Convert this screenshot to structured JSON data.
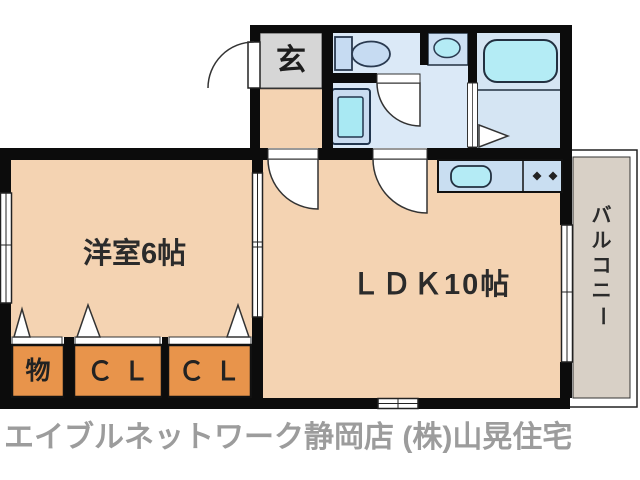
{
  "floor_plan": {
    "rooms": {
      "genkan": "玄",
      "western_room": "洋室6帖",
      "ldk": "ＬＤＫ10帖",
      "storage": "物",
      "closet_1": "ＣＬ",
      "closet_2": "ＣＬ",
      "balcony": "バルコニー",
      "balcony_chars": [
        "バ",
        "ル",
        "コ",
        "ニ",
        "ー"
      ]
    },
    "colors": {
      "wall": "#0c0c0c",
      "room_floor": "#f4d3b2",
      "closet": "#e8944b",
      "genkan_floor": "#d6d6d6",
      "sanitary_floor": "#dbe9f7",
      "bathroom_floor": "#d5e5f3",
      "fixture_cyan": "#b4ebf5",
      "fixture_blue": "#c9dcf0",
      "counter": "#c9def1",
      "balcony_floor": "#d8d0c6",
      "credit_text": "#9c9c9c"
    },
    "fixtures": [
      "entrance-door",
      "toilet",
      "washbasin",
      "bathtub",
      "bath-door",
      "washing-machine",
      "kitchen-sink",
      "stove-burners",
      "sliding-door",
      "windows",
      "closet-folding-doors"
    ]
  },
  "footer": {
    "credit": "エイブルネットワーク静岡店 (株)山晃住宅"
  }
}
